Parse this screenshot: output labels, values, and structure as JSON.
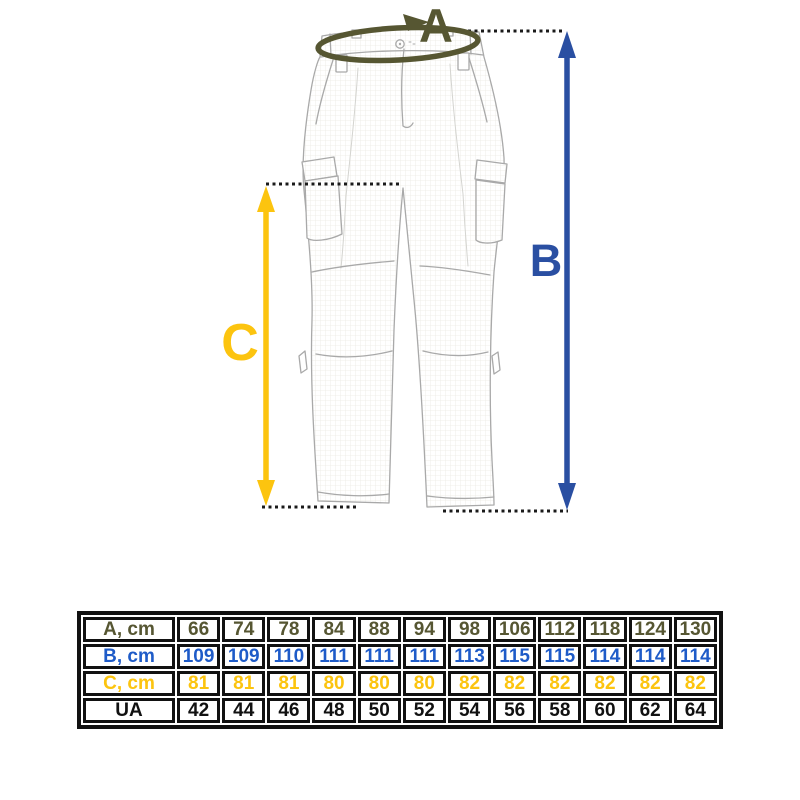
{
  "colors": {
    "olive": "#565632",
    "blue": "#2a4fa2",
    "yellow": "#fcc40f",
    "dotted": "#1a1a1a",
    "sketch": "#a9a9a9",
    "table_border": "#111111",
    "table_blue": "#1e5bc8",
    "table_yellow": "#fcc40f",
    "table_black": "#111111"
  },
  "diagram": {
    "label_a": "A",
    "label_b": "B",
    "label_c": "C",
    "description": "pants-measurement-sketch"
  },
  "size_table": {
    "rows": [
      {
        "label": "A, cm",
        "color": "#565632",
        "values": [
          "66",
          "74",
          "78",
          "84",
          "88",
          "94",
          "98",
          "106",
          "112",
          "118",
          "124",
          "130"
        ]
      },
      {
        "label": "B, cm",
        "color": "#1e5bc8",
        "values": [
          "109",
          "109",
          "110",
          "111",
          "111",
          "111",
          "113",
          "115",
          "115",
          "114",
          "114",
          "114"
        ]
      },
      {
        "label": "C, cm",
        "color": "#fcc40f",
        "values": [
          "81",
          "81",
          "81",
          "80",
          "80",
          "80",
          "82",
          "82",
          "82",
          "82",
          "82",
          "82"
        ]
      },
      {
        "label": "UA",
        "color": "#111111",
        "values": [
          "42",
          "44",
          "46",
          "48",
          "50",
          "52",
          "54",
          "56",
          "58",
          "60",
          "62",
          "64"
        ]
      }
    ]
  }
}
